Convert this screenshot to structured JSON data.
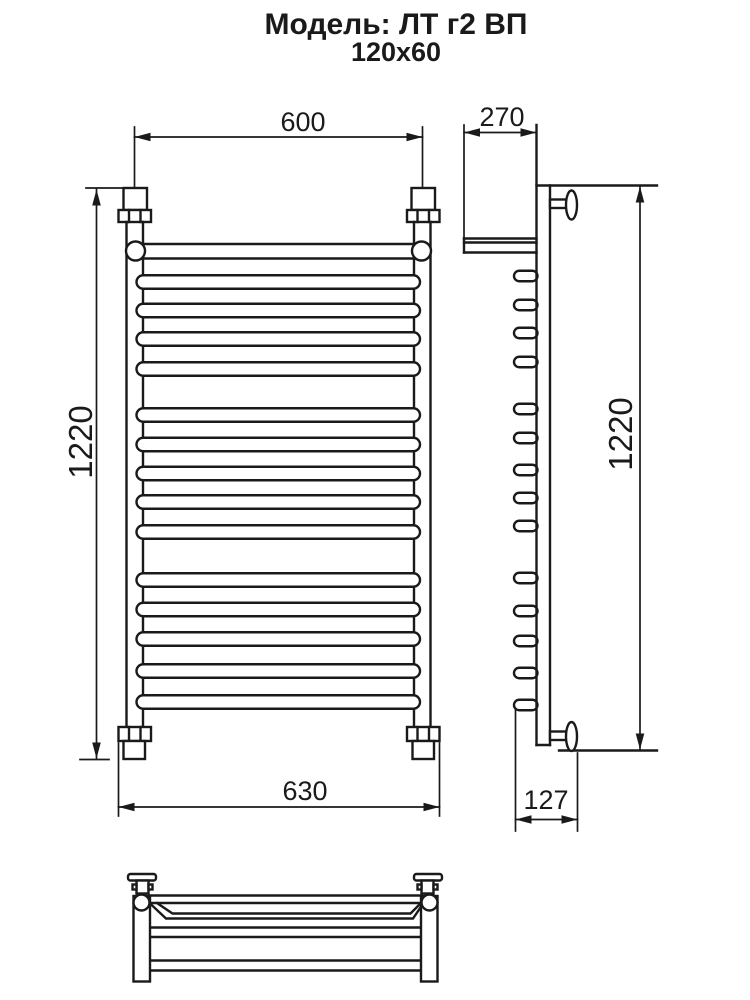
{
  "header": {
    "model": "Модель: ЛТ г2 ВП",
    "size": "120x60"
  },
  "dimensions": {
    "front": {
      "top_width": "600",
      "height": "1220",
      "bottom_width": "630"
    },
    "side": {
      "top_depth": "270",
      "height": "1220",
      "bottom_depth": "127"
    }
  }
}
